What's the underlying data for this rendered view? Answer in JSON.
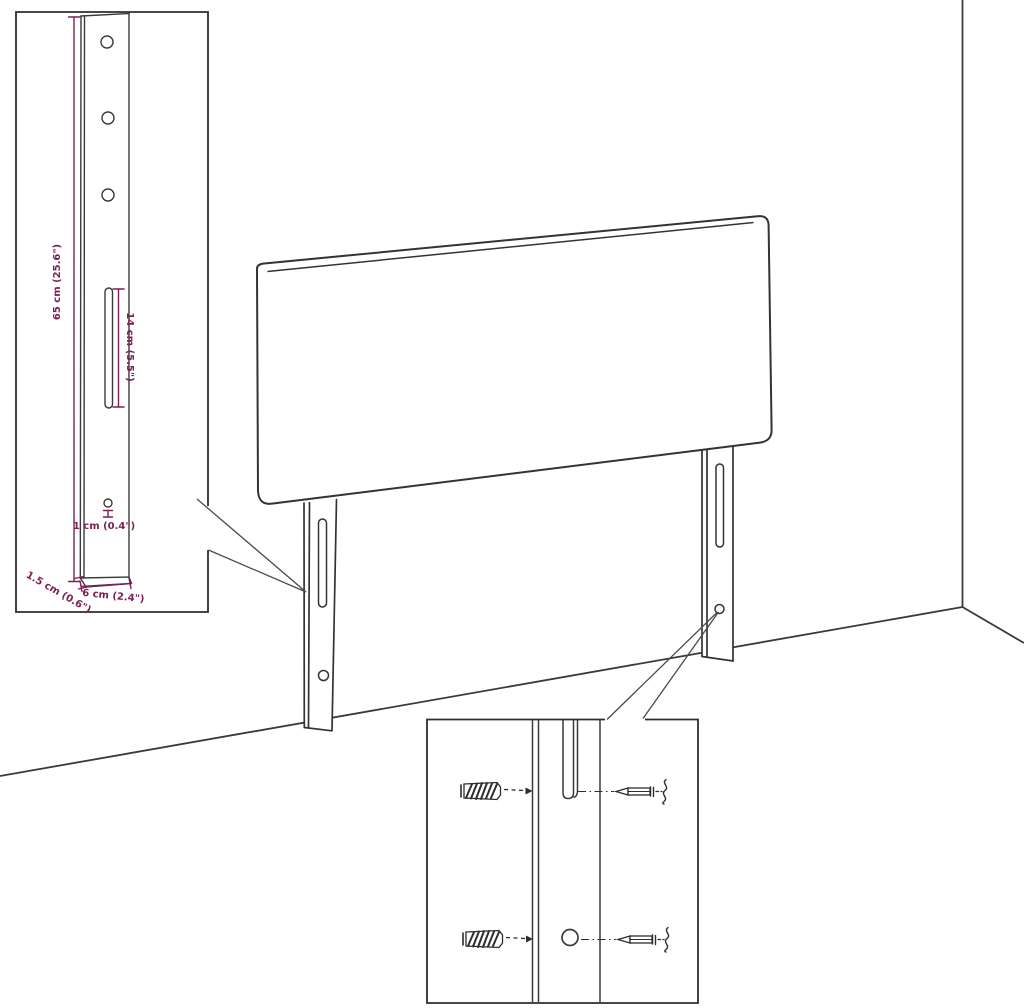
{
  "figure": {
    "type": "furniture-assembly-diagram",
    "subject": "headboard with mounting legs, wall corner scene, two detail insets",
    "background_color": "#ffffff",
    "line_color": "#333333",
    "dimension_color": "#7c2157"
  },
  "dimensions": {
    "leg_height": "65 cm (25.6\")",
    "slot_length": "14 cm (5.5\")",
    "hole_size": "1 cm (0.4\")",
    "leg_thickness": "1.5 cm (0.6\")",
    "leg_width": "6 cm (2.4\")"
  }
}
